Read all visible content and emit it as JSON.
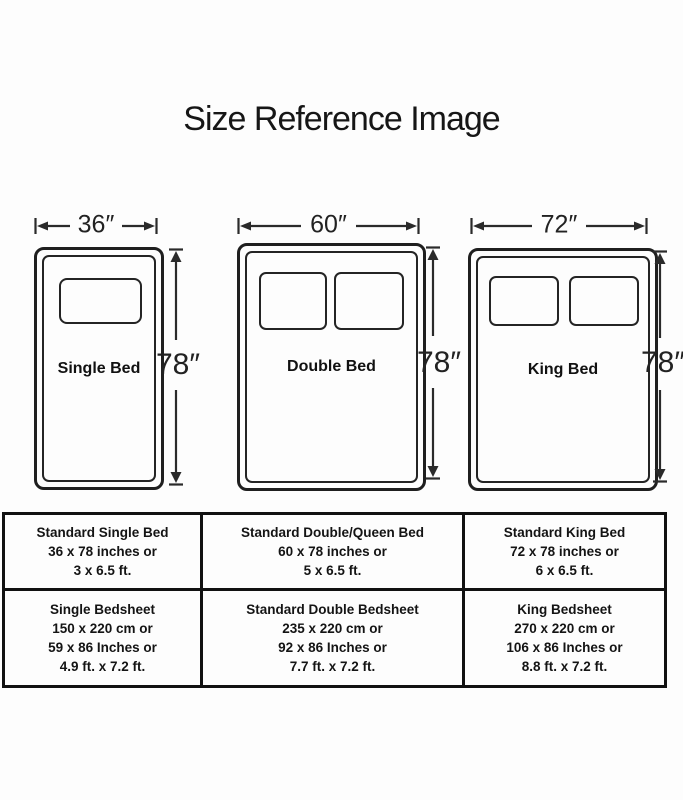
{
  "title": "Size Reference Image",
  "beds": [
    {
      "name": "single",
      "label": "Single Bed",
      "width_label": "36″",
      "height_label": "78″",
      "pillow_count": 1
    },
    {
      "name": "double",
      "label": "Double Bed",
      "width_label": "60″",
      "height_label": "78″",
      "pillow_count": 2
    },
    {
      "name": "king",
      "label": "King Bed",
      "width_label": "72″",
      "height_label": "78″",
      "pillow_count": 2
    }
  ],
  "table": {
    "rows": [
      [
        [
          "Standard Single Bed",
          "36 x 78 inches or",
          "3 x 6.5 ft."
        ],
        [
          "Standard Double/Queen Bed",
          "60 x 78 inches or",
          "5 x 6.5 ft."
        ],
        [
          "Standard King Bed",
          "72 x 78 inches or",
          "6 x 6.5 ft."
        ]
      ],
      [
        [
          "Single Bedsheet",
          "150 x 220 cm or",
          "59 x 86 Inches or",
          "4.9 ft. x 7.2 ft."
        ],
        [
          "Standard Double Bedsheet",
          "235 x 220 cm or",
          "92 x 86 Inches or",
          "7.7 ft. x 7.2 ft."
        ],
        [
          "King Bedsheet",
          "270 x 220 cm or",
          "106 x 86 Inches or",
          "8.8 ft. x 7.2 ft."
        ]
      ]
    ]
  },
  "colors": {
    "ink": "#1c1c1c",
    "background": "#fdfdfd"
  }
}
